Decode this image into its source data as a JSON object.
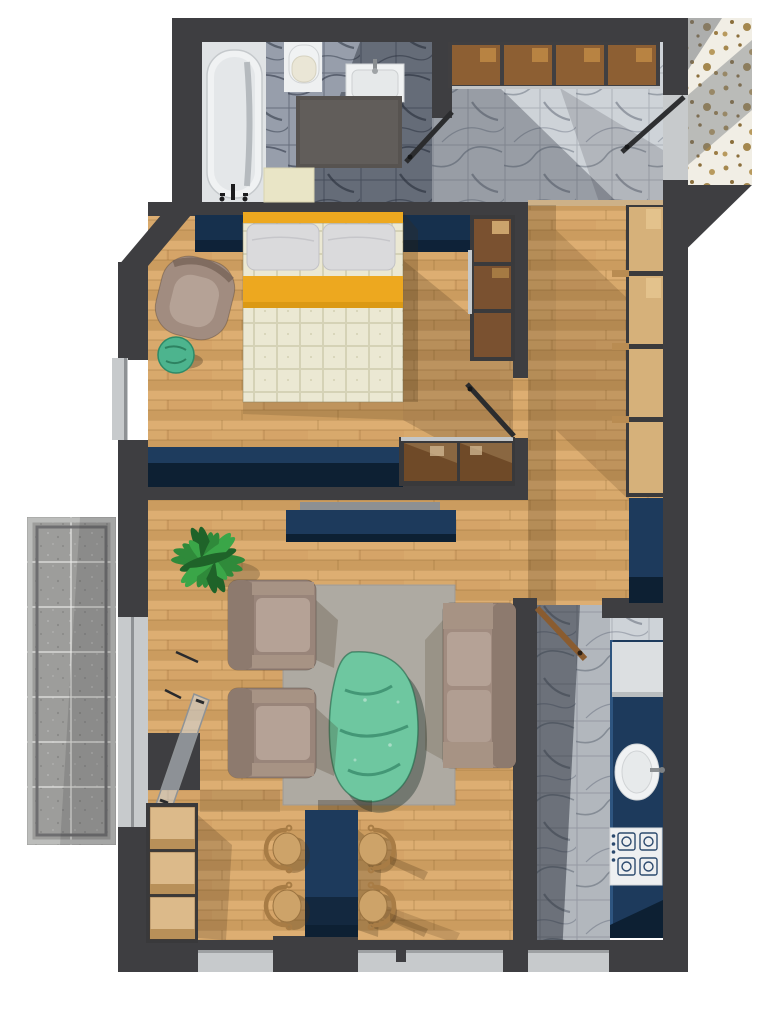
{
  "scene": {
    "type": "apartment floor plan, top-down 3D render",
    "title": "One-bedroom apartment floor plan"
  },
  "rooms": {
    "bathroom": "Bathroom",
    "entry": "Entry hall",
    "hallway": "Hallway",
    "bedroom": "Bedroom",
    "living": "Living room",
    "dining": "Dining area",
    "kitchen": "Kitchen",
    "balcony": "Balcony",
    "landing": "Building landing"
  },
  "furniture": {
    "bathtub": "Bathtub with floor faucet",
    "toilet": "Toilet",
    "bath_sink": "Washbasin vanity",
    "bath_rug": "Dark bath rug",
    "bath_mat": "Beige bath mat",
    "bathroom_door": "Bathroom door (open)",
    "entry_cabinets": "Entry wall cabinets (4 doors)",
    "entry_door": "Apartment entrance door (open)",
    "hall_wardrobe": "Hallway wardrobe (4 sections)",
    "hall_cabinet": "Navy hallway cabinet",
    "bed": "Double bed with quilted duvet",
    "bed_runner": "Yellow bed runner",
    "pillows": "Two pillows",
    "headboard": "Navy headboard panel",
    "bedroom_armchair": "Taupe armchair",
    "side_stool": "Teal side stool",
    "wardrobe_3door": "Glass-door wardrobe (3 sections)",
    "sideboard": "Navy low sideboard",
    "display_cabinet": "Glass display cabinet (2 doors)",
    "bedroom_door": "Bedroom door (open)",
    "tv": "Wall-mounted TV",
    "tv_console": "Navy TV console",
    "plant": "Potted plant",
    "rug": "Gray area rug",
    "coffee_table": "Teal organic coffee table",
    "armchair_1": "Living room armchair (top)",
    "armchair_2": "Living room armchair (bottom)",
    "sofa": "Taupe two-seat sofa",
    "balcony_door": "Balcony glass door (open)",
    "dining_table": "Navy dining table",
    "dining_chair": "Bentwood dining chair",
    "bench": "Storage bench (3 boxes)",
    "kitchen_door": "Kitchen door (open)",
    "counter": "Navy kitchen counter",
    "fridge": "Refrigerator",
    "kitchen_sink": "Round kitchen sink",
    "cooktop": "Gas cooktop (4 burners)",
    "window": "Window"
  },
  "colors": {
    "wall": "#3e3e41",
    "wood-base": "#d5a468",
    "wood-light": "#ddae72",
    "wood-dark": "#cb9c5f",
    "marble-light": "#ced3d8",
    "marble-dark": "#979eab",
    "terrazzo": "#f1eee5",
    "speck": "#a4874e",
    "concrete": "#9d9d9b",
    "navy": "#1d3a5c",
    "navy-dark": "#0d2033",
    "yellow": "#eda81f",
    "quilt": "#ebe8d3",
    "pillow": "#dadadc",
    "taupe": "#a18c80",
    "taupe-light": "#b5a296",
    "taupe-dark": "#8d7a6e",
    "teal": "#6ec7a0",
    "teal-dark": "#3f9c77",
    "rug": "#b6b1aa",
    "rug-dark": "#575350",
    "mat": "#e9e5c6",
    "fixture": "#f0f2f3",
    "sill": "#c7cacc",
    "cab-brown": "#8d5f33",
    "cab-brown-light": "#c08a45",
    "cab-light": "#d6b17a",
    "chair-wood": "#cda369",
    "chair-frame": "#a87c45",
    "plant-green": "#2f8a3a",
    "plant-green-dark": "#1f6329"
  }
}
